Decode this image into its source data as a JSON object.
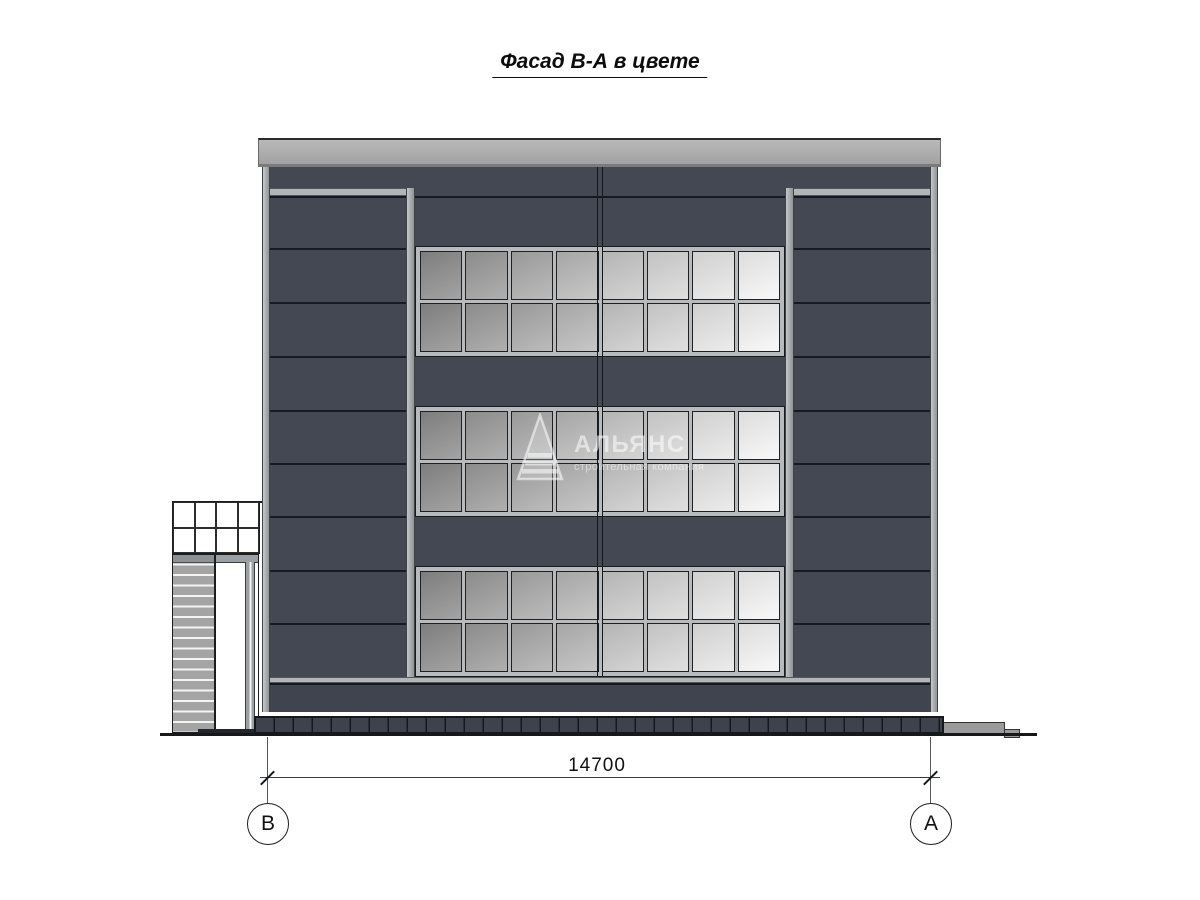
{
  "title": "Фасад В-А в цвете",
  "dimension": {
    "value": "14700"
  },
  "axis_markers": [
    {
      "label": "В"
    },
    {
      "label": "А"
    }
  ],
  "watermark": {
    "name": "АЛЬЯНС",
    "subtitle": "строительная компания"
  },
  "colors": {
    "panel_dark": "#434853",
    "panel_joint": "#171a20",
    "frame_light": "#b2b6b9",
    "parapet": "#a9a9a9",
    "glass_left": "#8c8c8c",
    "glass_right": "#f6f6f6",
    "plinth": "#3d424c",
    "concrete_step": "#9b9b9b",
    "outline": "#15181d",
    "background": "#ffffff"
  },
  "geometry": {
    "window_bands": 3,
    "window_cols": 8,
    "window_rows": 2,
    "band_tops": [
      79,
      239,
      399
    ],
    "wing_joint_y": [
      81,
      135,
      189,
      243,
      296,
      349,
      403,
      456
    ],
    "wing_joint_spans": [
      {
        "left": 8,
        "width": 136
      },
      {
        "left": 532,
        "width": 136
      }
    ],
    "glazing_cells": 8
  }
}
